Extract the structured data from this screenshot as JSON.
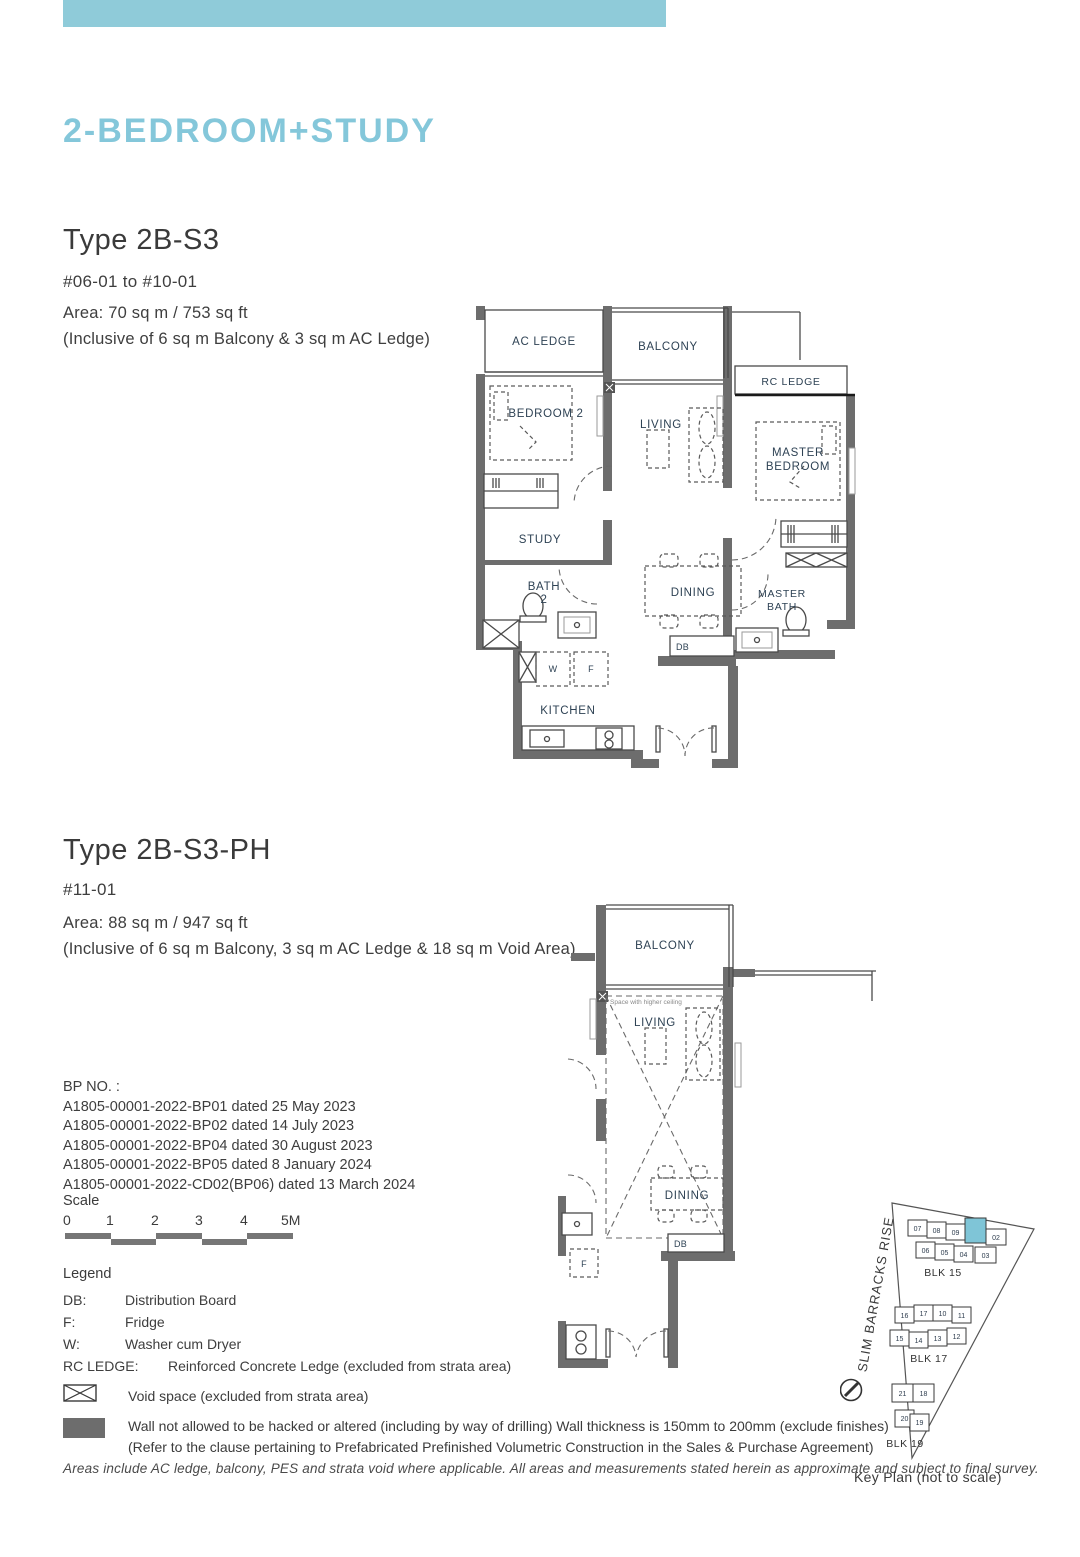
{
  "page": {
    "title": "2-BEDROOM+STUDY",
    "accent_color": "#8fcbd9",
    "footer_note": "Areas include AC ledge, balcony, PES and strata void where applicable. All areas and measurements stated herein as approximate and subject to final survey."
  },
  "unit_a": {
    "type_label": "Type 2B-S3",
    "levels": "#06-01 to #10-01",
    "area_line1": "Area: 70 sq m / 753 sq ft",
    "area_line2": "(Inclusive of 6 sq m Balcony & 3 sq m AC Ledge)"
  },
  "unit_b": {
    "type_label": "Type 2B-S3-PH",
    "levels": "#11-01",
    "area_line1": "Area: 88 sq m / 947 sq ft",
    "area_line2": "(Inclusive of 6 sq m Balcony, 3 sq m AC Ledge & 18 sq m Void Area)"
  },
  "bp": {
    "heading": "BP NO. :",
    "items": [
      "A1805-00001-2022-BP01 dated 25 May 2023",
      "A1805-00001-2022-BP02 dated 14 July 2023",
      "A1805-00001-2022-BP04 dated 30 August 2023",
      "A1805-00001-2022-BP05 dated 8 January 2024",
      "A1805-00001-2022-CD02(BP06) dated 13 March 2024"
    ]
  },
  "scale": {
    "label": "Scale",
    "ticks": [
      "0",
      "1",
      "2",
      "3",
      "4",
      "5M"
    ]
  },
  "legend": {
    "heading": "Legend",
    "items": [
      {
        "abbr": "DB:",
        "desc": "Distribution Board"
      },
      {
        "abbr": "F:",
        "desc": "Fridge"
      },
      {
        "abbr": "W:",
        "desc": "Washer cum Dryer"
      },
      {
        "abbr": "RC LEDGE:",
        "desc": "Reinforced Concrete Ledge (excluded from strata area)"
      }
    ],
    "void_note": "Void space (excluded from strata area)",
    "wall_note_line1": "Wall not allowed to be hacked or altered (including by way of drilling) Wall thickness is 150mm to 200mm (exclude finishes)",
    "wall_note_line2": "(Refer to the clause pertaining to Prefabricated Prefinished Volumetric Construction in the Sales & Purchase Agreement)"
  },
  "plan_a": {
    "rooms": {
      "ac_ledge": "AC LEDGE",
      "balcony": "BALCONY",
      "rc_ledge": "RC LEDGE",
      "bedroom2": "BEDROOM 2",
      "living": "LIVING",
      "master_l1": "MASTER",
      "master_l2": "BEDROOM",
      "study": "STUDY",
      "bath2_l1": "BATH",
      "bath2_l2": "2",
      "dining": "DINING",
      "mbath_l1": "MASTER",
      "mbath_l2": "BATH",
      "kitchen": "KITCHEN",
      "db": "DB",
      "w": "W",
      "f": "F"
    }
  },
  "plan_b": {
    "rooms": {
      "balcony": "BALCONY",
      "living": "LIVING",
      "dining": "DINING",
      "db": "DB",
      "f": "F",
      "higher_ceiling": "Space with higher ceiling"
    }
  },
  "keyplan": {
    "street": "SLIM BARRACKS RISE",
    "caption": "Key Plan (not to scale)",
    "highlight_color": "#7fc5d7",
    "blk15": {
      "label": "BLK 15",
      "row1": [
        "07",
        "08",
        "09",
        "02"
      ],
      "row2": [
        "06",
        "05",
        "04",
        "03"
      ]
    },
    "blk17": {
      "label": "BLK 17",
      "row1": [
        "16",
        "17",
        "10",
        "11"
      ],
      "row2": [
        "15",
        "14",
        "13",
        "12"
      ]
    },
    "blk19": {
      "label": "BLK 19",
      "row1": [
        "21",
        "18"
      ],
      "row2": [
        "20",
        "19"
      ]
    }
  }
}
